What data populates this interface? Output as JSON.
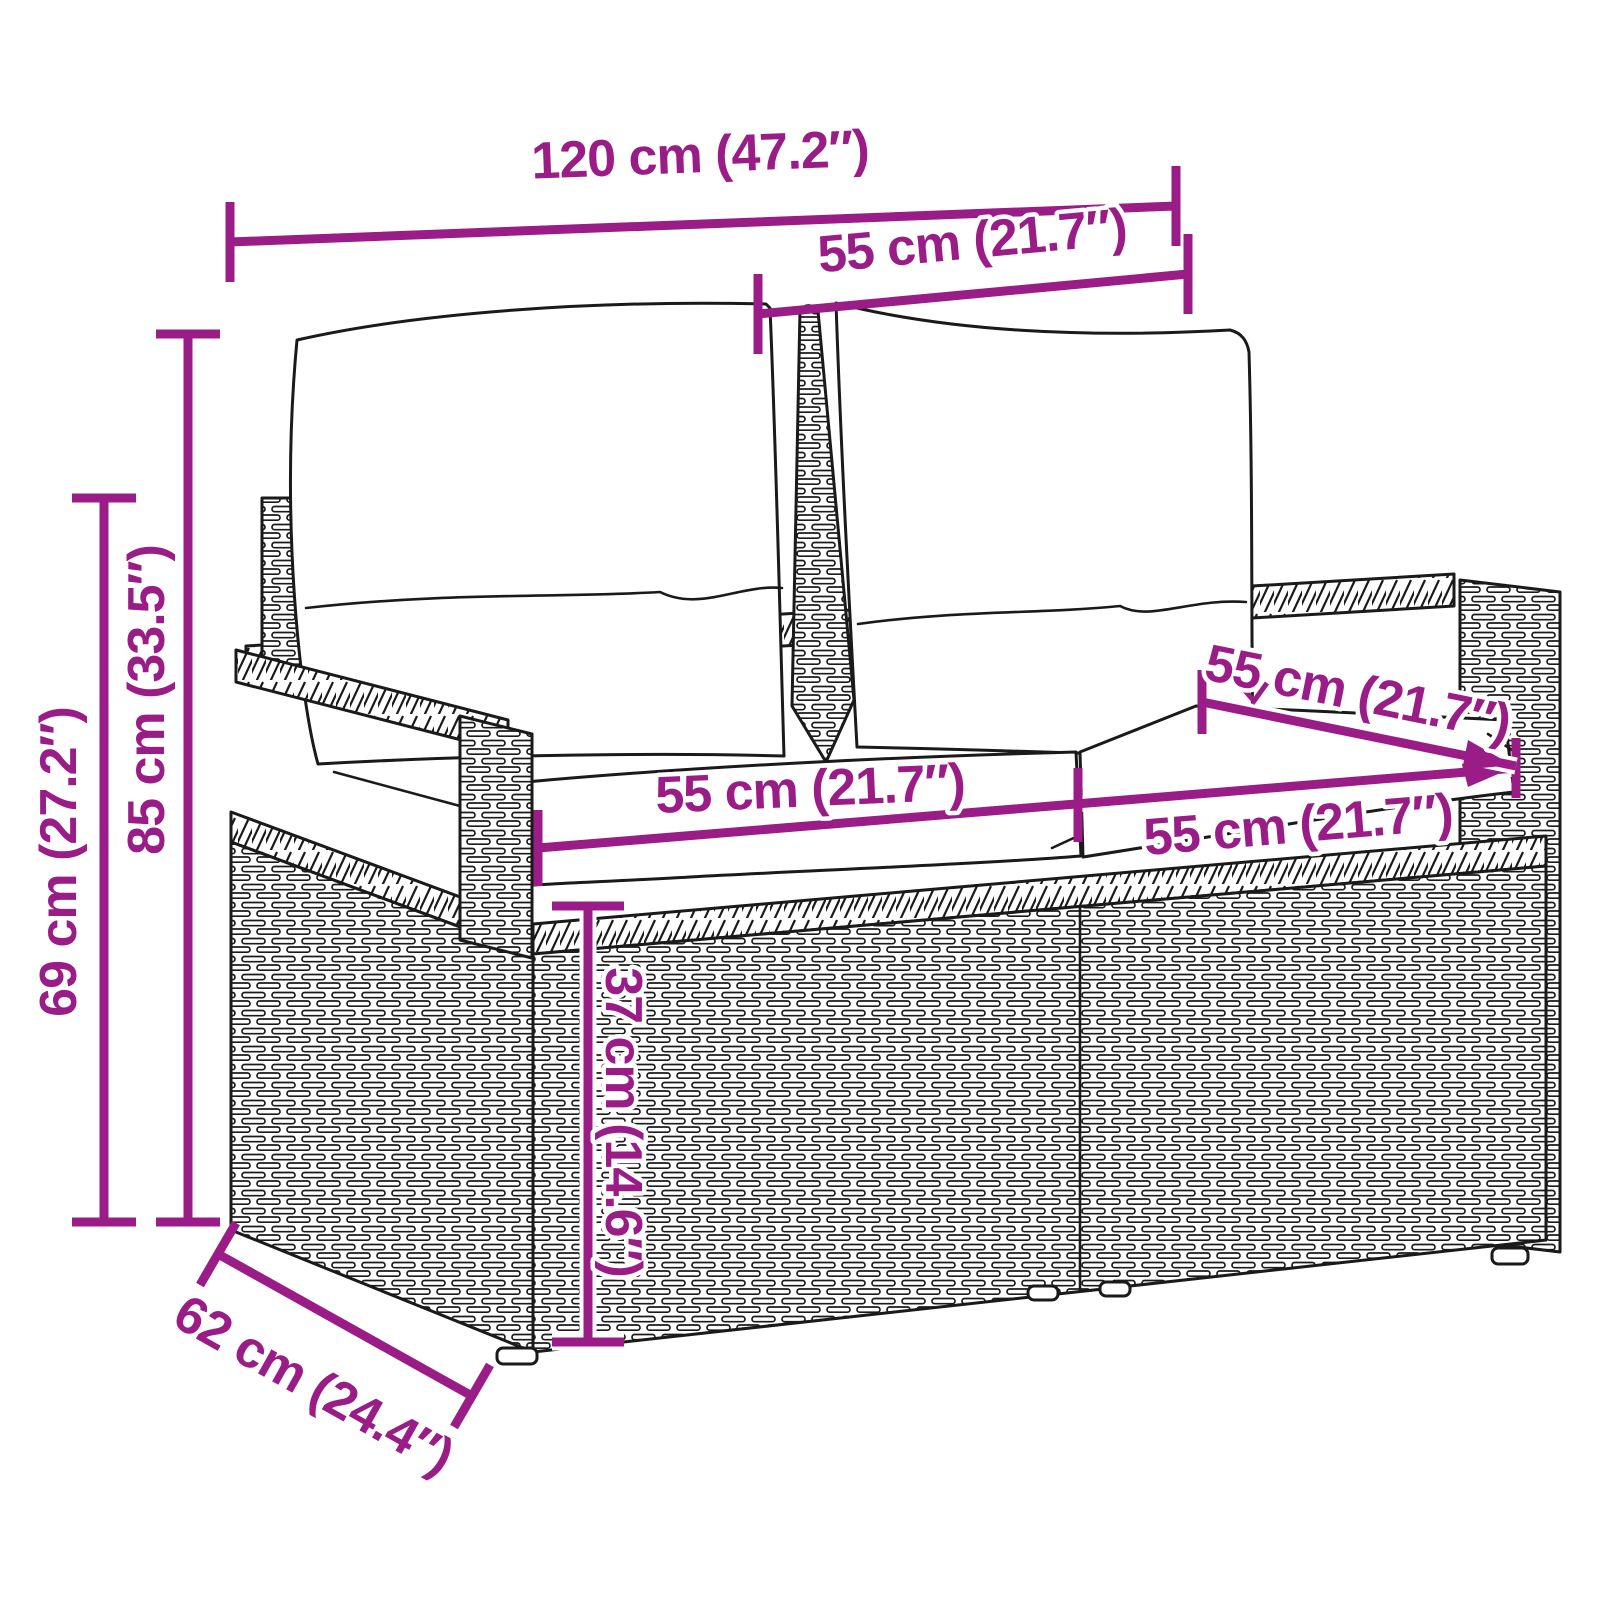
{
  "diagram": {
    "subject": "rattan-garden-bench-with-cushions-dimension-drawing",
    "accent_color": "#9A1C87",
    "outline_color": "#1A1A1A",
    "background_color": "#FFFFFF",
    "dims": {
      "overall_width": "120 cm (47.2″)",
      "back_cushion_width": "55 cm (21.7″)",
      "total_height": "85 cm (33.5″)",
      "armrest_height": "69 cm (27.2″)",
      "seat_depth": "55 cm (21.7″)",
      "seat_width_left": "55 cm (21.7″)",
      "seat_width_right": "55 cm (21.7″)",
      "seat_height": "37 cm (14.6″)",
      "overall_depth": "62 cm (24.4″)"
    }
  }
}
